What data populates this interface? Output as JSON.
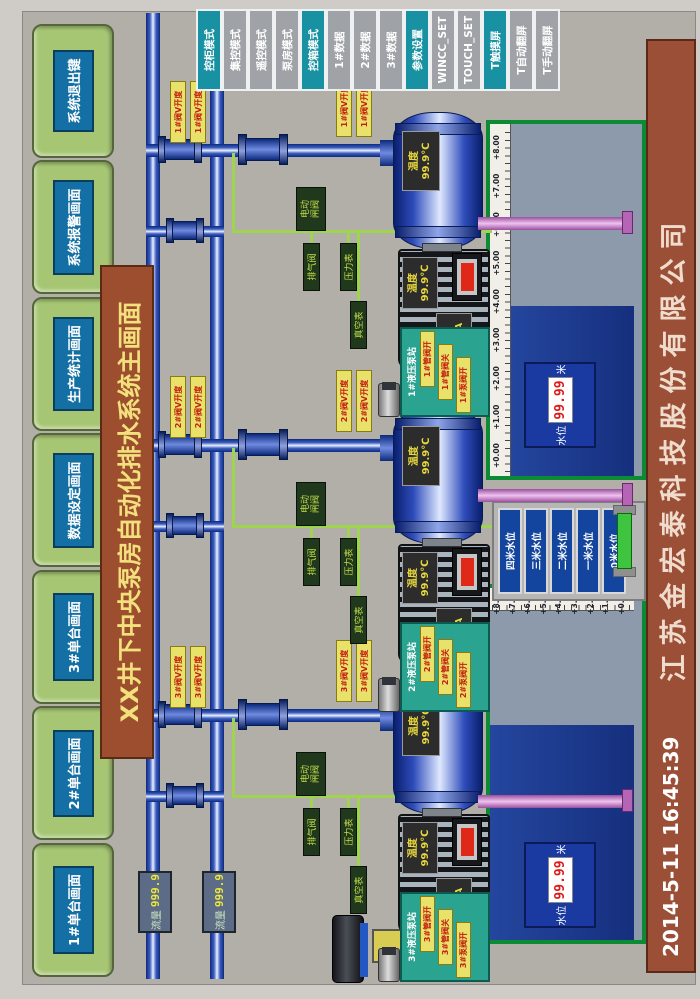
{
  "window": {
    "title_banner": "XX井下中央泵房自动化排水系统主画面",
    "company": "江苏金宏泰科技股份有限公司",
    "datetime": "2014-5-11 16:45:39"
  },
  "top_buttons": [
    "1#单台画面",
    "2#单台画面",
    "3#单台画面",
    "数据设定画面",
    "生产统计画面",
    "系统报警画面",
    "系统退出键"
  ],
  "right_buttons": [
    {
      "label": "控柜模式",
      "accent": true
    },
    {
      "label": "集控模式",
      "accent": false
    },
    {
      "label": "遥控模式",
      "accent": false
    },
    {
      "label": "泵房模式",
      "accent": false
    },
    {
      "label": "控箱模式",
      "accent": true
    },
    {
      "label": "1#数据",
      "accent": false
    },
    {
      "label": "2#数据",
      "accent": false
    },
    {
      "label": "3#数据",
      "accent": false
    },
    {
      "label": "参数设置",
      "accent": true
    },
    {
      "label": "WINCC_SET",
      "accent": false
    },
    {
      "label": "TOUCH_SET",
      "accent": false
    },
    {
      "label": "T触摸屏",
      "accent": true
    },
    {
      "label": "T自动翻屏",
      "accent": false
    },
    {
      "label": "T手动翻屏",
      "accent": false
    }
  ],
  "flow_meters": [
    {
      "label": "流量",
      "value": "999.9"
    },
    {
      "label": "流量",
      "value": "999.9"
    }
  ],
  "units": [
    {
      "id": "3#",
      "x": 235,
      "pink_left": 186,
      "valve_tags": [
        "3#阀V开度",
        "3#阀V开度",
        "3#阀V开度",
        "3#阀V开度"
      ],
      "boxes": {
        "gate_line1": "电动",
        "gate_line2": "闸阀",
        "air": "排气阀",
        "pressure": "压力表",
        "vacuum": "真空表"
      },
      "pump": {
        "temp_label": "温度",
        "temp_value": "99.9℃"
      },
      "motor": {
        "current_label": "电流",
        "current_value": "99.9A",
        "temp_label": "温度",
        "temp_value": "99.9℃"
      },
      "panel": {
        "title": "3#液压泵站",
        "tags": [
          "3#管阀开",
          "3#管阀关",
          "3#泵阀开"
        ]
      }
    },
    {
      "id": "2#",
      "x": 505,
      "pink_left": 222,
      "valve_tags": [
        "2#阀V开度",
        "2#阀V开度",
        "2#阀V开度",
        "2#阀V开度"
      ],
      "boxes": {
        "gate_line1": "电动",
        "gate_line2": "闸阀",
        "air": "排气阀",
        "pressure": "压力表",
        "vacuum": "真空表"
      },
      "pump": {
        "temp_label": "温度",
        "temp_value": "99.9℃"
      },
      "motor": {
        "current_label": "电流",
        "current_value": "99.9A",
        "temp_label": "温度",
        "temp_value": "99.9℃"
      },
      "panel": {
        "title": "2#液压泵站",
        "tags": [
          "2#管阀开",
          "2#管阀关",
          "2#泵阀开"
        ]
      }
    },
    {
      "id": "1#",
      "x": 800,
      "pink_left": 199,
      "valve_tags": [
        "1#阀V开度",
        "1#阀V开度",
        "1#阀V开度",
        "1#阀V开度"
      ],
      "boxes": {
        "gate_line1": "电动",
        "gate_line2": "闸阀",
        "air": "排气阀",
        "pressure": "压力表",
        "vacuum": "真空表"
      },
      "pump": {
        "temp_label": "温度",
        "temp_value": "99.9℃"
      },
      "motor": {
        "current_label": "电流",
        "current_value": "99.9A",
        "temp_label": "温度",
        "temp_value": "99.9℃"
      },
      "panel": {
        "title": "1#液压泵站",
        "tags": [
          "1#管阀开",
          "1#管阀关",
          "1#泵阀开"
        ]
      }
    }
  ],
  "sump_scale_labels": [
    "+8.00",
    "+7.00",
    "+6.00",
    "+5.00",
    "+4.00",
    "+3.00",
    "+2.00",
    "+1.00",
    "+0.00"
  ],
  "sumps": {
    "right": {
      "level_label": "水位",
      "level_value": "99.99",
      "level_unit": "米"
    },
    "left": {
      "level_label": "水位",
      "level_value": "99.99",
      "level_unit": "米"
    }
  },
  "level_buttons": [
    "四米水位",
    "三米水位",
    "二米水位",
    "一米水位",
    "0米水位"
  ],
  "colors": {
    "accent_teal": "#1892a2",
    "button_green": "#a6c674",
    "banner_brown": "#9c4e2e",
    "pipe_blue": "#1b3aa6",
    "suction_pink": "#d48ad4",
    "water_blue": "#1c3a96",
    "alarm_red": "#e02818",
    "signal_green": "#9ed44e"
  }
}
